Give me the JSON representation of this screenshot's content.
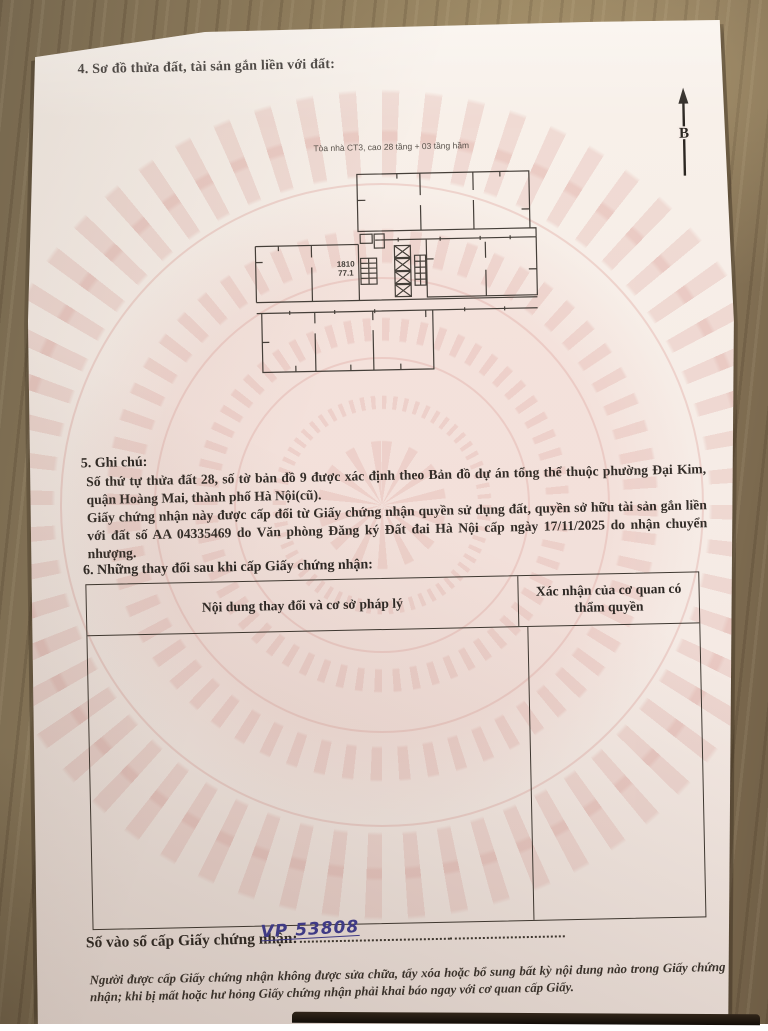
{
  "doc": {
    "section4_heading": "4. Sơ đồ thửa đất, tài sản gắn liền với đất:",
    "plan": {
      "caption": "Tòa nhà CT3, cao 28 tầng + 03 tầng hầm",
      "unit_number": "1810",
      "unit_area": "77.1",
      "north_label": "B"
    },
    "section5_heading": "5. Ghi chú:",
    "section5_note1": "Số thứ tự thửa đất 28, số tờ bản đồ 9 được xác định theo Bản đồ dự án tổng thể thuộc phường Đại Kim, quận Hoàng Mai, thành phố Hà Nội(cũ).",
    "section5_note2": "Giấy chứng nhận này được cấp đổi từ Giấy chứng nhận quyền sử dụng đất, quyền sở hữu tài sản gắn liền với đất số AA 04335469 do Văn phòng Đăng ký Đất đai Hà Nội cấp ngày 17/11/2025 do nhận chuyển nhượng.",
    "section6_heading": "6. Những thay đổi sau khi cấp Giấy chứng nhận:",
    "table": {
      "col1_header": "Nội dung thay đổi và cơ sở pháp lý",
      "col2_header": "Xác nhận của cơ quan có thẩm quyền"
    },
    "registry_label": "Số vào sổ cấp Giấy chứng nhận:",
    "registry_value": "VP 53808",
    "footer_note": "Người được cấp Giấy chứng nhận không được sửa chữa, tẩy xóa hoặc bổ sung bất kỳ nội dung nào trong Giấy chứng nhận; khi bị mất hoặc hư hỏng Giấy chứng nhận phải khai báo ngay với cơ quan cấp Giấy."
  },
  "colors": {
    "paper": "#f6ece6",
    "pattern_pink": "#e0aca4",
    "ink": "#2e2925",
    "handwriting_blue": "#3e3c94",
    "wood": "#8a7859"
  }
}
